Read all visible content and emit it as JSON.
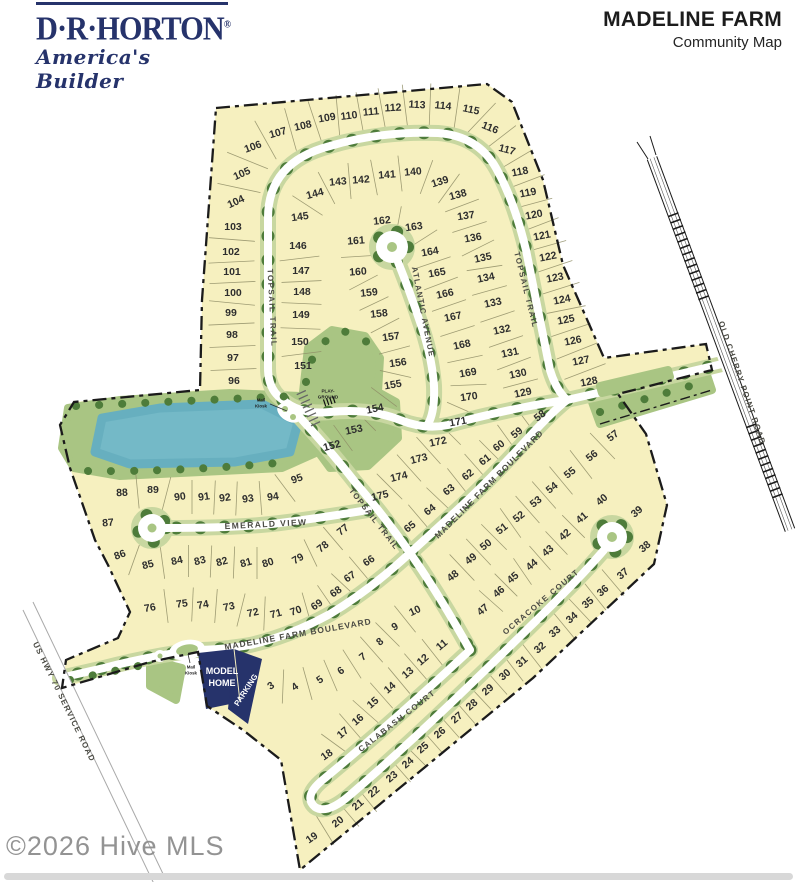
{
  "header": {
    "logo": {
      "brand": "D·R·HORTON",
      "registered": "®",
      "tagline": "America's Builder"
    },
    "title": "MADELINE FARM",
    "subtitle": "Community Map"
  },
  "watermark": "©2026 Hive MLS",
  "map": {
    "colors": {
      "navy": "#26336b",
      "lot_fill": "#f6f0bf",
      "green": "#a9c583",
      "verge": "#c8d7a0",
      "tree": "#4e7c3a",
      "pond": "#74b9c7",
      "boundary": "#1b1b1b"
    },
    "street_names": [
      {
        "text": "TOPSAIL TRAIL",
        "x": 272,
        "y": 308,
        "r": 87,
        "fs": 8,
        "ls": 1.4
      },
      {
        "text": "TOPSAIL TRAIL",
        "x": 526,
        "y": 290,
        "r": 76,
        "fs": 8,
        "ls": 1.4
      },
      {
        "text": "TOPSAIL TRAIL",
        "x": 374,
        "y": 519,
        "r": 52,
        "fs": 8,
        "ls": 1.2
      },
      {
        "text": "ATLANTIC AVENUE",
        "x": 423,
        "y": 312,
        "r": 79,
        "fs": 8,
        "ls": 1.2
      },
      {
        "text": "EMERALD VIEW",
        "x": 266,
        "y": 524,
        "r": -3,
        "fs": 8.5,
        "ls": 1.4
      },
      {
        "text": "MADELINE FARM BOULEVARD",
        "x": 489,
        "y": 484,
        "r": -45,
        "fs": 8.5,
        "ls": 1
      },
      {
        "text": "MADELINE FARM BOULEVARD",
        "x": 298,
        "y": 634,
        "r": -10,
        "fs": 8.5,
        "ls": 1
      },
      {
        "text": "OCRACOKE COURT",
        "x": 541,
        "y": 602,
        "r": -40,
        "fs": 8,
        "ls": 1.4
      },
      {
        "text": "CALABASH COURT",
        "x": 397,
        "y": 721,
        "r": -38,
        "fs": 8,
        "ls": 1.4
      },
      {
        "text": "OLD CHERRY POINT ROAD",
        "x": 742,
        "y": 383,
        "r": 71,
        "fs": 8,
        "ls": 1.2
      },
      {
        "text": "US HWY 70 SERVICE ROAD",
        "x": 64,
        "y": 702,
        "r": 64,
        "fs": 8,
        "ls": 1.2
      }
    ],
    "small_labels": [
      {
        "text": "MODEL",
        "x": 222,
        "y": 671,
        "r": 0,
        "fs": 9,
        "fill": "#ffffff"
      },
      {
        "text": "HOME",
        "x": 222,
        "y": 683,
        "r": 0,
        "fs": 9,
        "fill": "#ffffff"
      },
      {
        "text": "PARKING",
        "x": 246,
        "y": 690,
        "r": -57,
        "fs": 8,
        "fill": "#ffffff"
      },
      {
        "text": "PLAY-",
        "x": 328,
        "y": 391,
        "r": 0,
        "fs": 4.6,
        "fill": "#222222"
      },
      {
        "text": "GROUND",
        "x": 328,
        "y": 397,
        "r": 0,
        "fs": 4.6,
        "fill": "#222222"
      },
      {
        "text": "Mail",
        "x": 261,
        "y": 400,
        "r": 0,
        "fs": 4.4,
        "fill": "#222222"
      },
      {
        "text": "Kiosk",
        "x": 261,
        "y": 406,
        "r": 0,
        "fs": 4.4,
        "fill": "#222222"
      },
      {
        "text": "Mail",
        "x": 191,
        "y": 667,
        "r": 0,
        "fs": 4.4,
        "fill": "#222222"
      },
      {
        "text": "Kiosk",
        "x": 191,
        "y": 673,
        "r": 0,
        "fs": 4.4,
        "fill": "#222222"
      }
    ],
    "lots": [
      [
        3,
        271,
        686,
        -35
      ],
      [
        4,
        295,
        687,
        -35
      ],
      [
        5,
        320,
        680,
        -35
      ],
      [
        6,
        341,
        671,
        -35
      ],
      [
        7,
        363,
        657,
        -38
      ],
      [
        8,
        380,
        642,
        -40
      ],
      [
        9,
        395,
        627,
        -30
      ],
      [
        10,
        415,
        611,
        -25
      ],
      [
        11,
        442,
        645,
        -40
      ],
      [
        12,
        423,
        660,
        -40
      ],
      [
        13,
        408,
        673,
        -40
      ],
      [
        14,
        390,
        688,
        -40
      ],
      [
        15,
        373,
        703,
        -40
      ],
      [
        16,
        358,
        720,
        -40
      ],
      [
        17,
        343,
        733,
        -40
      ],
      [
        18,
        327,
        755,
        -35
      ],
      [
        19,
        312,
        838,
        -35
      ],
      [
        20,
        338,
        822,
        -38
      ],
      [
        21,
        358,
        805,
        -40
      ],
      [
        22,
        374,
        792,
        -40
      ],
      [
        23,
        392,
        777,
        -40
      ],
      [
        24,
        408,
        763,
        -40
      ],
      [
        25,
        423,
        748,
        -40
      ],
      [
        26,
        440,
        733,
        -40
      ],
      [
        27,
        457,
        718,
        -40
      ],
      [
        28,
        472,
        705,
        -40
      ],
      [
        29,
        488,
        690,
        -40
      ],
      [
        30,
        505,
        675,
        -40
      ],
      [
        31,
        522,
        662,
        -40
      ],
      [
        32,
        540,
        648,
        -40
      ],
      [
        33,
        555,
        632,
        -40
      ],
      [
        34,
        572,
        618,
        -40
      ],
      [
        35,
        588,
        603,
        -40
      ],
      [
        36,
        603,
        591,
        -40
      ],
      [
        37,
        623,
        574,
        -40
      ],
      [
        38,
        645,
        547,
        -40
      ],
      [
        39,
        637,
        512,
        -40
      ],
      [
        40,
        602,
        500,
        -40
      ],
      [
        41,
        582,
        518,
        -40
      ],
      [
        42,
        565,
        535,
        -40
      ],
      [
        43,
        548,
        551,
        -40
      ],
      [
        44,
        532,
        565,
        -40
      ],
      [
        45,
        513,
        578,
        -40
      ],
      [
        46,
        499,
        592,
        -40
      ],
      [
        47,
        483,
        610,
        -40
      ],
      [
        48,
        453,
        576,
        -38
      ],
      [
        49,
        471,
        559,
        -38
      ],
      [
        50,
        486,
        545,
        -38
      ],
      [
        51,
        502,
        529,
        -38
      ],
      [
        52,
        519,
        517,
        -38
      ],
      [
        53,
        536,
        502,
        -38
      ],
      [
        54,
        552,
        488,
        -38
      ],
      [
        55,
        570,
        473,
        -38
      ],
      [
        56,
        592,
        456,
        -38
      ],
      [
        57,
        613,
        436,
        -38
      ],
      [
        58,
        540,
        416,
        -38
      ],
      [
        59,
        517,
        433,
        -38
      ],
      [
        60,
        499,
        446,
        -38
      ],
      [
        61,
        485,
        460,
        -38
      ],
      [
        62,
        468,
        475,
        -38
      ],
      [
        63,
        449,
        490,
        -38
      ],
      [
        64,
        430,
        510,
        -38
      ],
      [
        65,
        410,
        527,
        -38
      ],
      [
        66,
        369,
        561,
        -35
      ],
      [
        67,
        350,
        577,
        -35
      ],
      [
        68,
        336,
        592,
        -35
      ],
      [
        69,
        317,
        605,
        -35
      ],
      [
        70,
        296,
        611,
        -20
      ],
      [
        71,
        276,
        614,
        -15
      ],
      [
        72,
        253,
        613,
        -12
      ],
      [
        73,
        229,
        607,
        -12
      ],
      [
        74,
        203,
        605,
        -10
      ],
      [
        75,
        182,
        604,
        -8
      ],
      [
        76,
        150,
        608,
        -10
      ],
      [
        77,
        343,
        530,
        -38
      ],
      [
        78,
        323,
        547,
        -38
      ],
      [
        79,
        298,
        559,
        -30
      ],
      [
        80,
        268,
        563,
        -18
      ],
      [
        81,
        246,
        563,
        -16
      ],
      [
        82,
        222,
        562,
        -15
      ],
      [
        83,
        200,
        561,
        -14
      ],
      [
        84,
        177,
        561,
        -12
      ],
      [
        85,
        148,
        565,
        -15
      ],
      [
        86,
        120,
        555,
        -20
      ],
      [
        87,
        108,
        523,
        -5
      ],
      [
        88,
        122,
        493,
        -3
      ],
      [
        89,
        153,
        490,
        0
      ],
      [
        90,
        180,
        497,
        -8
      ],
      [
        91,
        204,
        497,
        -8
      ],
      [
        92,
        225,
        498,
        -8
      ],
      [
        93,
        248,
        499,
        -8
      ],
      [
        94,
        273,
        497,
        -8
      ],
      [
        95,
        297,
        479,
        -20
      ],
      [
        96,
        234,
        381,
        0
      ],
      [
        97,
        233,
        358,
        0
      ],
      [
        98,
        232,
        335,
        0
      ],
      [
        99,
        231,
        313,
        0
      ],
      [
        100,
        233,
        293,
        0
      ],
      [
        101,
        232,
        272,
        0
      ],
      [
        102,
        231,
        252,
        0
      ],
      [
        103,
        233,
        227,
        0
      ],
      [
        104,
        236,
        202,
        -25
      ],
      [
        105,
        242,
        174,
        -24
      ],
      [
        106,
        253,
        147,
        -20
      ],
      [
        107,
        278,
        133,
        -16
      ],
      [
        108,
        303,
        126,
        -13
      ],
      [
        109,
        327,
        118,
        -10
      ],
      [
        110,
        349,
        116,
        -7
      ],
      [
        111,
        371,
        112,
        -5
      ],
      [
        112,
        393,
        108,
        -3
      ],
      [
        113,
        417,
        105,
        3
      ],
      [
        114,
        443,
        106,
        6
      ],
      [
        115,
        471,
        110,
        12
      ],
      [
        116,
        490,
        128,
        22
      ],
      [
        117,
        507,
        150,
        15
      ],
      [
        118,
        520,
        172,
        -11
      ],
      [
        119,
        528,
        193,
        -11
      ],
      [
        120,
        534,
        215,
        -11
      ],
      [
        121,
        542,
        236,
        -11
      ],
      [
        122,
        548,
        257,
        -11
      ],
      [
        123,
        555,
        278,
        -11
      ],
      [
        124,
        562,
        300,
        -11
      ],
      [
        125,
        566,
        320,
        -11
      ],
      [
        126,
        573,
        341,
        -11
      ],
      [
        127,
        581,
        361,
        -11
      ],
      [
        128,
        589,
        382,
        -11
      ],
      [
        129,
        523,
        393,
        -12
      ],
      [
        130,
        518,
        374,
        -12
      ],
      [
        131,
        510,
        353,
        -12
      ],
      [
        132,
        502,
        330,
        -12
      ],
      [
        133,
        493,
        303,
        -12
      ],
      [
        134,
        486,
        278,
        -12
      ],
      [
        135,
        483,
        258,
        -12
      ],
      [
        136,
        473,
        238,
        -10
      ],
      [
        137,
        466,
        216,
        -8
      ],
      [
        138,
        458,
        195,
        -15
      ],
      [
        139,
        440,
        182,
        -18
      ],
      [
        140,
        413,
        172,
        -5
      ],
      [
        141,
        387,
        175,
        -4
      ],
      [
        142,
        361,
        180,
        -4
      ],
      [
        143,
        338,
        182,
        -5
      ],
      [
        144,
        315,
        194,
        -15
      ],
      [
        145,
        300,
        217,
        -8
      ],
      [
        146,
        298,
        246,
        0
      ],
      [
        147,
        301,
        271,
        0
      ],
      [
        148,
        302,
        292,
        0
      ],
      [
        149,
        301,
        315,
        0
      ],
      [
        150,
        300,
        342,
        0
      ],
      [
        151,
        303,
        366,
        0
      ],
      [
        152,
        332,
        446,
        -15
      ],
      [
        153,
        354,
        430,
        -12
      ],
      [
        154,
        375,
        409,
        -12
      ],
      [
        155,
        393,
        385,
        -10
      ],
      [
        156,
        398,
        363,
        -8
      ],
      [
        157,
        391,
        337,
        -8
      ],
      [
        158,
        379,
        314,
        -6
      ],
      [
        159,
        369,
        293,
        -6
      ],
      [
        160,
        358,
        272,
        -4
      ],
      [
        161,
        356,
        241,
        -4
      ],
      [
        162,
        382,
        221,
        -6
      ],
      [
        163,
        414,
        227,
        -8
      ],
      [
        164,
        430,
        252,
        -10
      ],
      [
        165,
        437,
        273,
        -10
      ],
      [
        166,
        445,
        294,
        -12
      ],
      [
        167,
        453,
        317,
        -12
      ],
      [
        168,
        462,
        345,
        -12
      ],
      [
        169,
        468,
        373,
        -10
      ],
      [
        170,
        469,
        397,
        -8
      ],
      [
        171,
        458,
        422,
        -10
      ],
      [
        172,
        438,
        442,
        -12
      ],
      [
        173,
        419,
        459,
        -14
      ],
      [
        174,
        399,
        477,
        -14
      ],
      [
        175,
        380,
        496,
        -14
      ]
    ],
    "lot_rows": [
      {
        "lots": [
          96,
          97,
          98,
          99,
          100,
          101,
          102,
          103
        ],
        "len": 46
      },
      {
        "lots": [
          104,
          105,
          106,
          107,
          108,
          109,
          110,
          111,
          112,
          113,
          114,
          115,
          116,
          117,
          118,
          119,
          120,
          121,
          122,
          123,
          124,
          125,
          126,
          127,
          128
        ],
        "len": 44
      },
      {
        "lots": [
          129,
          130,
          131,
          132,
          133,
          134,
          135,
          136,
          137,
          138,
          139,
          140,
          141,
          142,
          143,
          144,
          145
        ],
        "len": 36
      },
      {
        "lots": [
          146,
          147,
          148,
          149,
          150,
          151
        ],
        "len": 40
      },
      {
        "lots": [
          152,
          153,
          154,
          155,
          156,
          157,
          158,
          159,
          160,
          161
        ],
        "len": 32
      },
      {
        "lots": [
          162,
          163,
          164,
          165,
          166,
          167,
          168,
          169,
          170,
          171,
          172,
          173,
          174,
          175
        ],
        "len": 36
      },
      {
        "lots": [
          58,
          59,
          60,
          61,
          62,
          63,
          64,
          65
        ],
        "len": 36
      },
      {
        "lots": [
          48,
          49,
          50,
          51,
          52,
          53,
          54,
          55,
          56,
          57
        ],
        "len": 36
      },
      {
        "lots": [
          41,
          42,
          43,
          44,
          45,
          46,
          47
        ],
        "len": 32
      },
      {
        "lots": [
          33,
          34,
          35,
          36,
          37
        ],
        "len": 34
      },
      {
        "lots": [
          23,
          24,
          25,
          26,
          27,
          28,
          29,
          30,
          31,
          32
        ],
        "len": 32
      },
      {
        "lots": [
          19,
          20,
          21,
          22
        ],
        "len": 34
      },
      {
        "lots": [
          11,
          12,
          13,
          14,
          15,
          16,
          17,
          18
        ],
        "len": 34
      },
      {
        "lots": [
          3,
          4,
          5,
          6,
          7,
          8,
          9,
          10
        ],
        "len": 34
      },
      {
        "lots": [
          66,
          67,
          68,
          69,
          70
        ],
        "len": 32
      },
      {
        "lots": [
          71,
          72,
          73,
          74,
          75,
          76
        ],
        "len": 34
      },
      {
        "lots": [
          77,
          78,
          79
        ],
        "len": 30
      },
      {
        "lots": [
          80,
          81,
          82,
          83,
          84,
          85,
          86
        ],
        "len": 32
      },
      {
        "lots": [
          88,
          89,
          90,
          91,
          92,
          93,
          94,
          95
        ],
        "len": 34
      }
    ]
  }
}
